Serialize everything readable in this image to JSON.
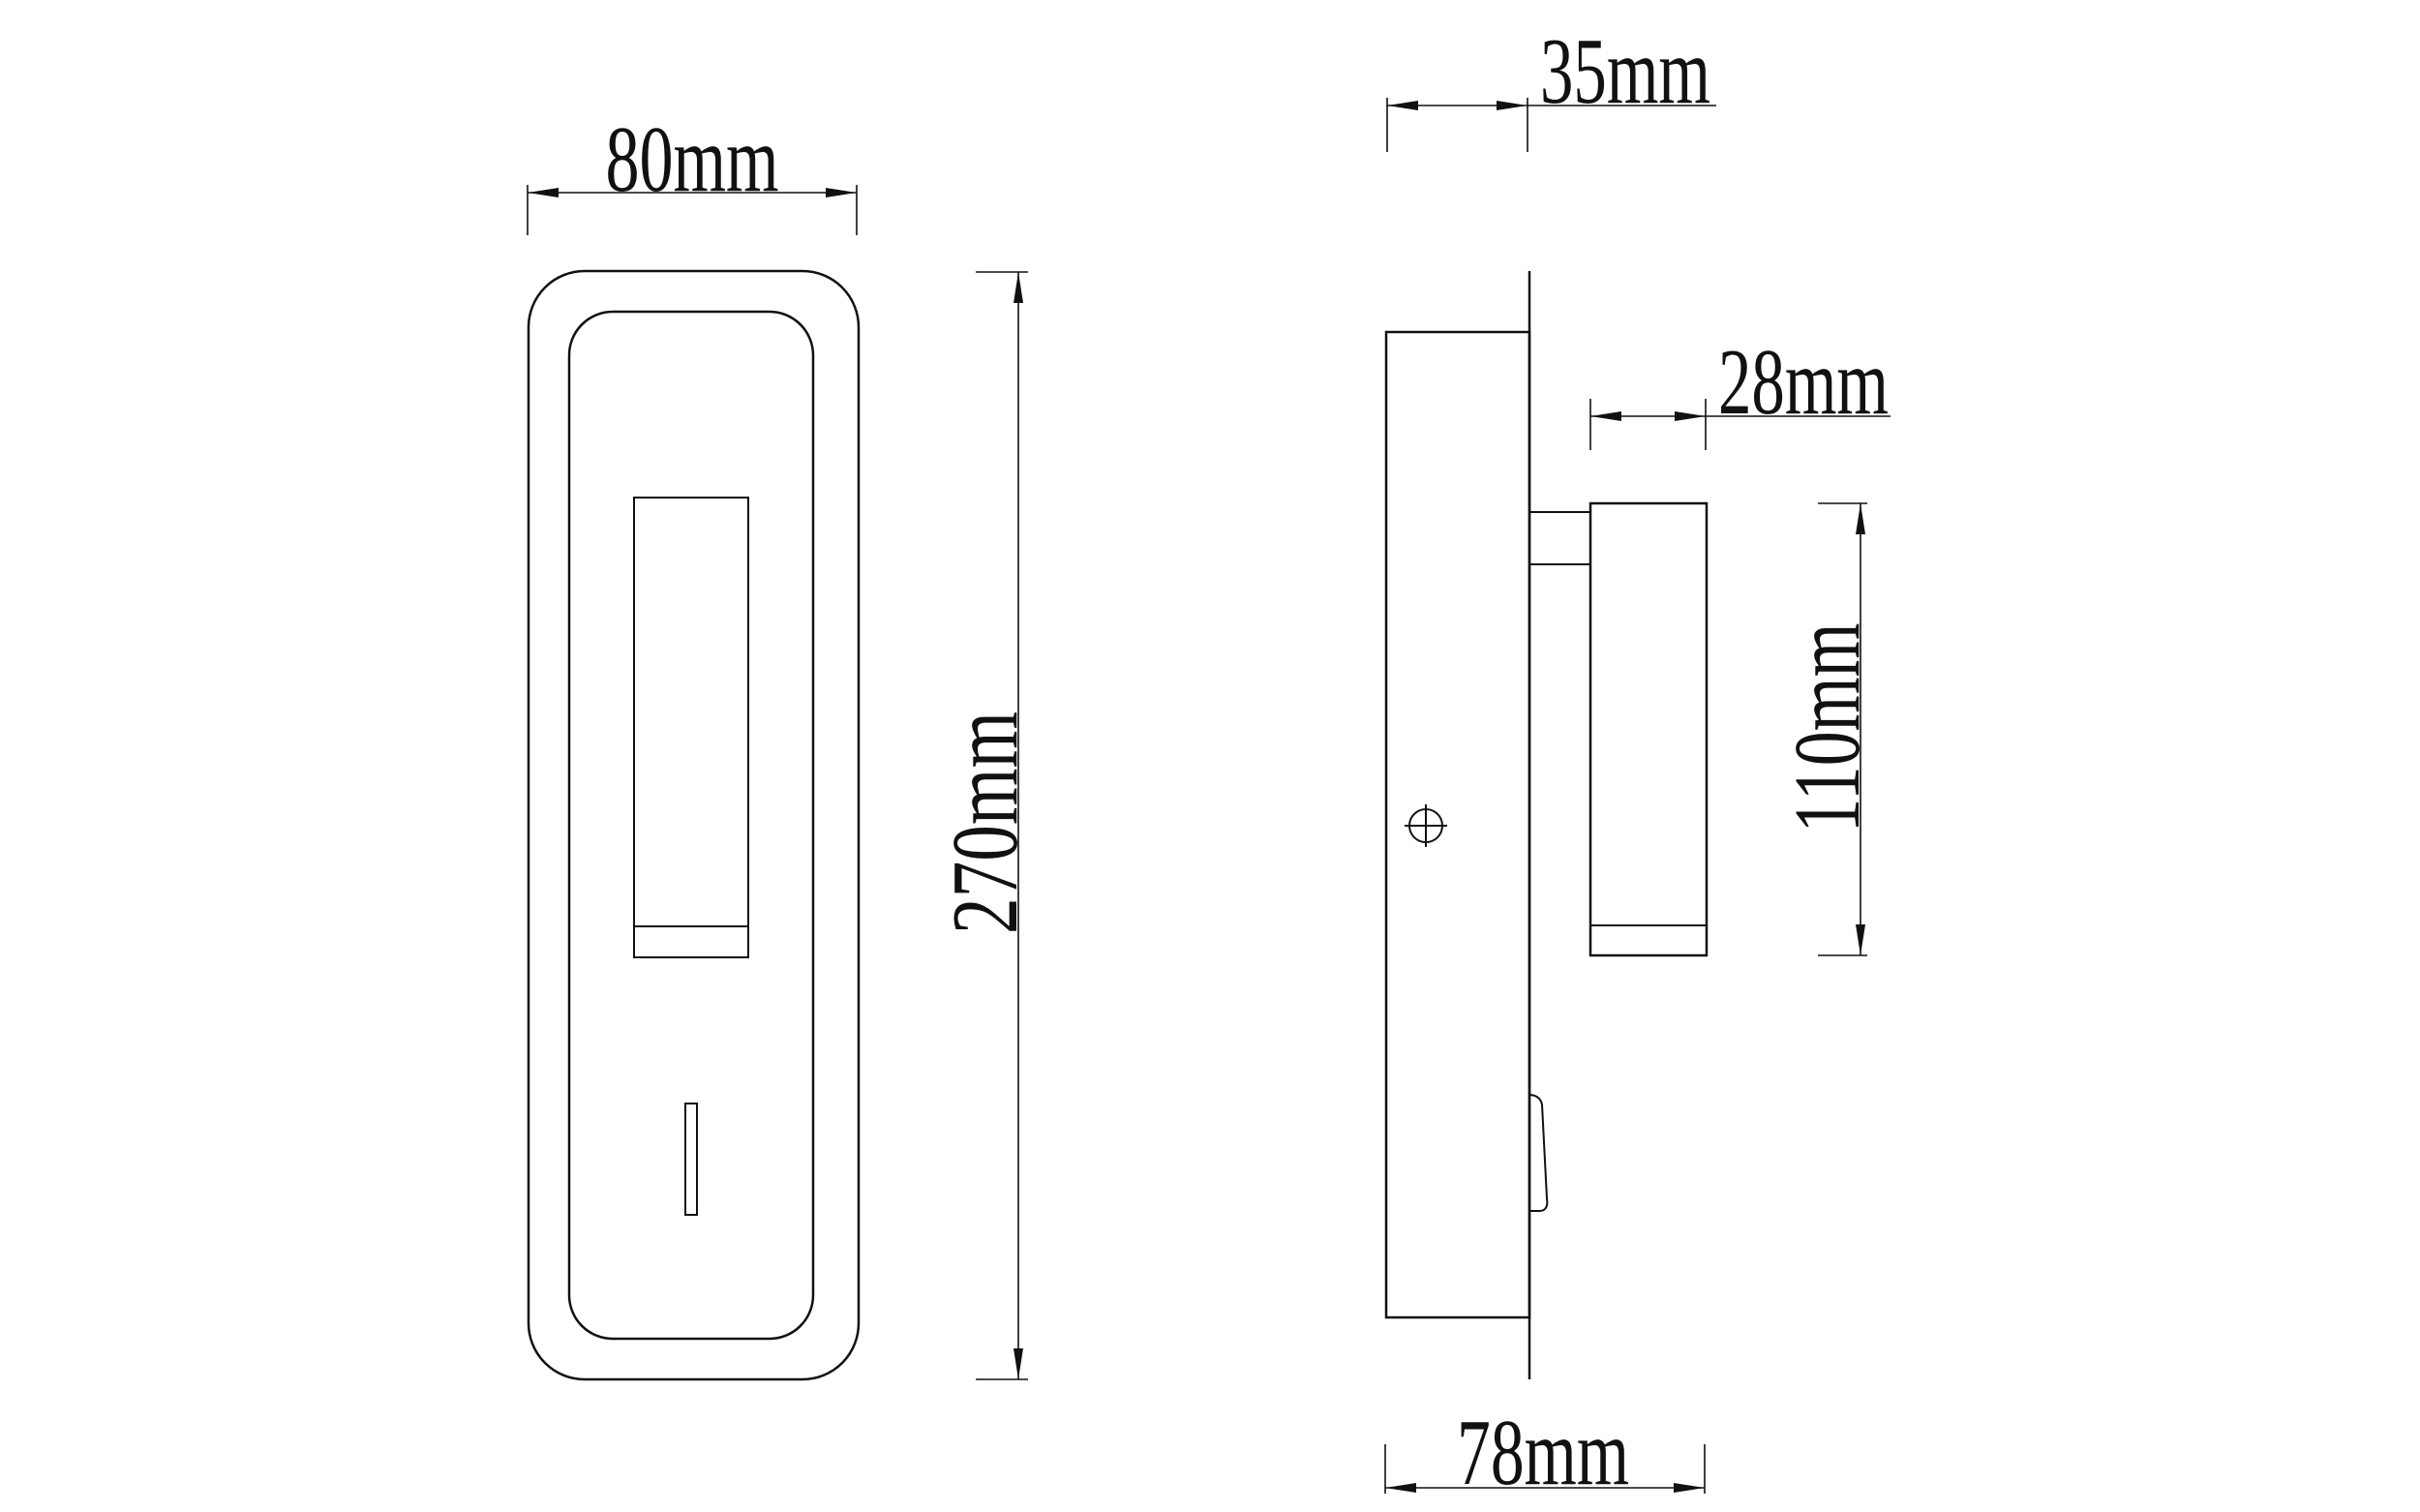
{
  "drawing": {
    "type": "technical-dimension-drawing",
    "subject": "wall-mounted reading lamp, front view and side view",
    "colors": {
      "background": "#ffffff",
      "line": "#111111"
    },
    "views": {
      "front": {
        "name": "front view"
      },
      "side": {
        "name": "side view"
      }
    },
    "dimensions": {
      "front_width": {
        "label": "80mm",
        "value": 80,
        "unit": "mm"
      },
      "front_height": {
        "label": "270mm",
        "value": 270,
        "unit": "mm"
      },
      "plate_depth": {
        "label": "35mm",
        "value": 35,
        "unit": "mm"
      },
      "head_diameter": {
        "label": "28mm",
        "value": 28,
        "unit": "mm"
      },
      "head_length": {
        "label": "110mm",
        "value": 110,
        "unit": "mm"
      },
      "total_depth": {
        "label": "78mm",
        "value": 78,
        "unit": "mm"
      }
    }
  }
}
